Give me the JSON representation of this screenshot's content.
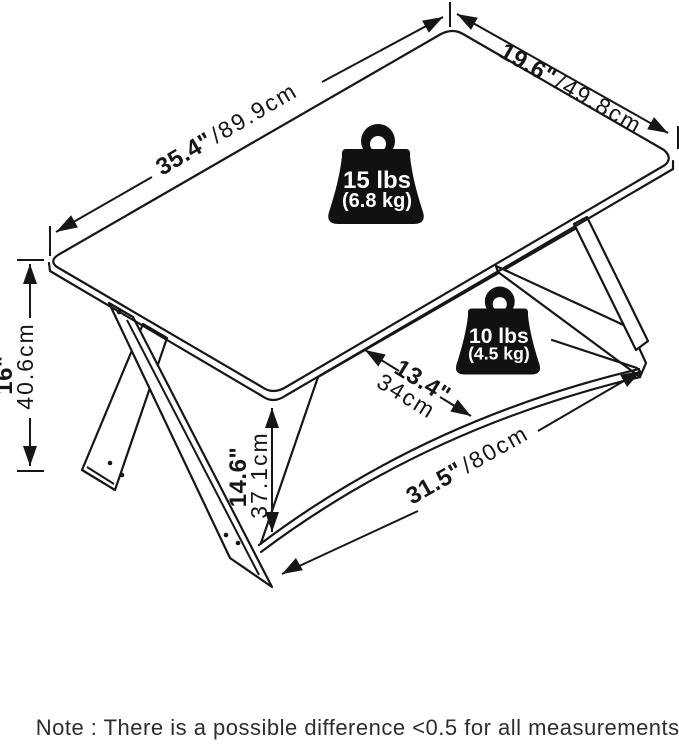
{
  "diagram": {
    "title": "coffee table dimension diagram",
    "dim_top_length_in": "35.4\"",
    "dim_top_length_cm": "/89.9cm",
    "dim_top_width_in": "19.6\"",
    "dim_top_width_cm": "/49.8cm",
    "dim_height_in": "16\"",
    "dim_height_cm": "40.6cm",
    "dim_clearance_in": "14.6\"",
    "dim_clearance_cm": "37.1cm",
    "dim_shelf_depth_in": "13.4\"",
    "dim_shelf_depth_cm": "34cm",
    "dim_shelf_length_in": "31.5\"",
    "dim_shelf_length_cm": "/80cm",
    "weight_top_lbs": "15 lbs",
    "weight_top_kg": "(6.8 kg)",
    "weight_shelf_lbs": "10 lbs",
    "weight_shelf_kg": "(4.5 kg)"
  },
  "note": "Note : There is a possible difference <0.5 for all measurements.",
  "colors": {
    "line": "#161616",
    "badge": "#111111",
    "badge_text": "#ffffff",
    "note_text": "#2d2d2d",
    "background": "#ffffff"
  }
}
